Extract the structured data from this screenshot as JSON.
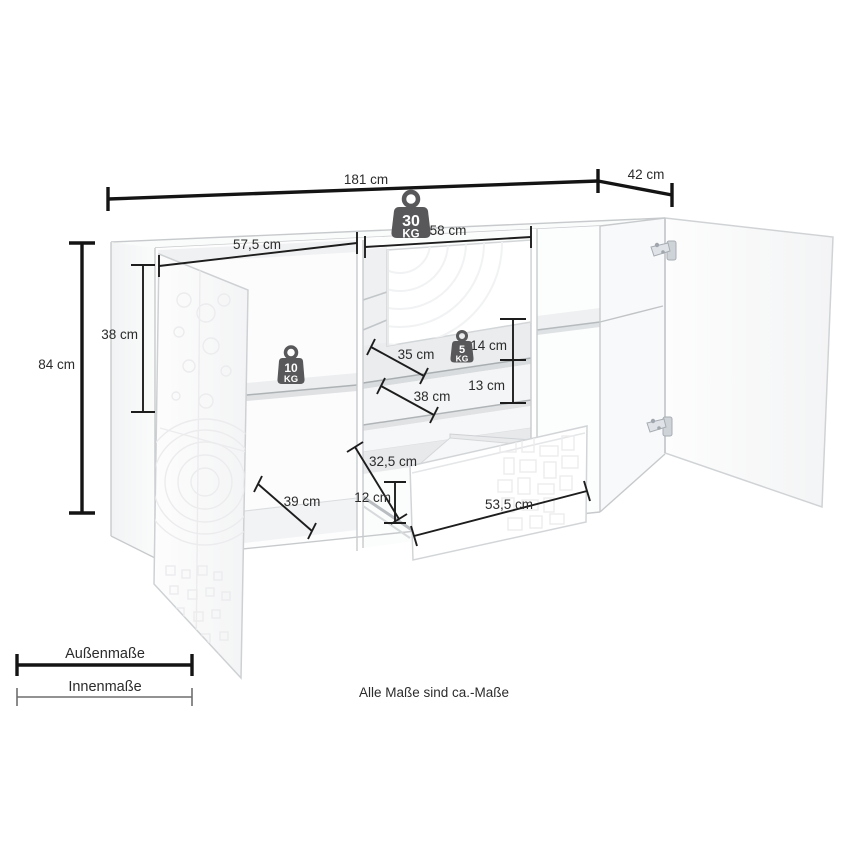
{
  "title": "Sideboard Bemaßungsdiagramm",
  "dimensions": {
    "outer_width": "181 cm",
    "outer_depth": "42 cm",
    "outer_height": "84 cm",
    "left_inner_height": "38 cm",
    "left_inner_width": "57,5 cm",
    "middle_inner_width": "58 cm",
    "shelf_depth_upper": "35 cm",
    "gap_upper": "14 cm",
    "gap_lower": "13 cm",
    "shelf_depth_lower": "38 cm",
    "left_floor_depth": "39 cm",
    "drawer_depth": "32,5 cm",
    "drawer_inner_height": "12 cm",
    "drawer_inner_width": "53,5 cm"
  },
  "weights": {
    "top": {
      "value": "30",
      "unit": "KG"
    },
    "left_shelf": {
      "value": "10",
      "unit": "KG"
    },
    "middle_shelf": {
      "value": "5",
      "unit": "KG"
    }
  },
  "legend": {
    "outer": "Außenmaße",
    "inner": "Innenmaße"
  },
  "footer": {
    "note": "Alle Maße sind ca.-Maße"
  },
  "colors": {
    "badge": "#58585a",
    "dimension_line": "#141414",
    "cabinet_edge": "#c7cacc"
  }
}
